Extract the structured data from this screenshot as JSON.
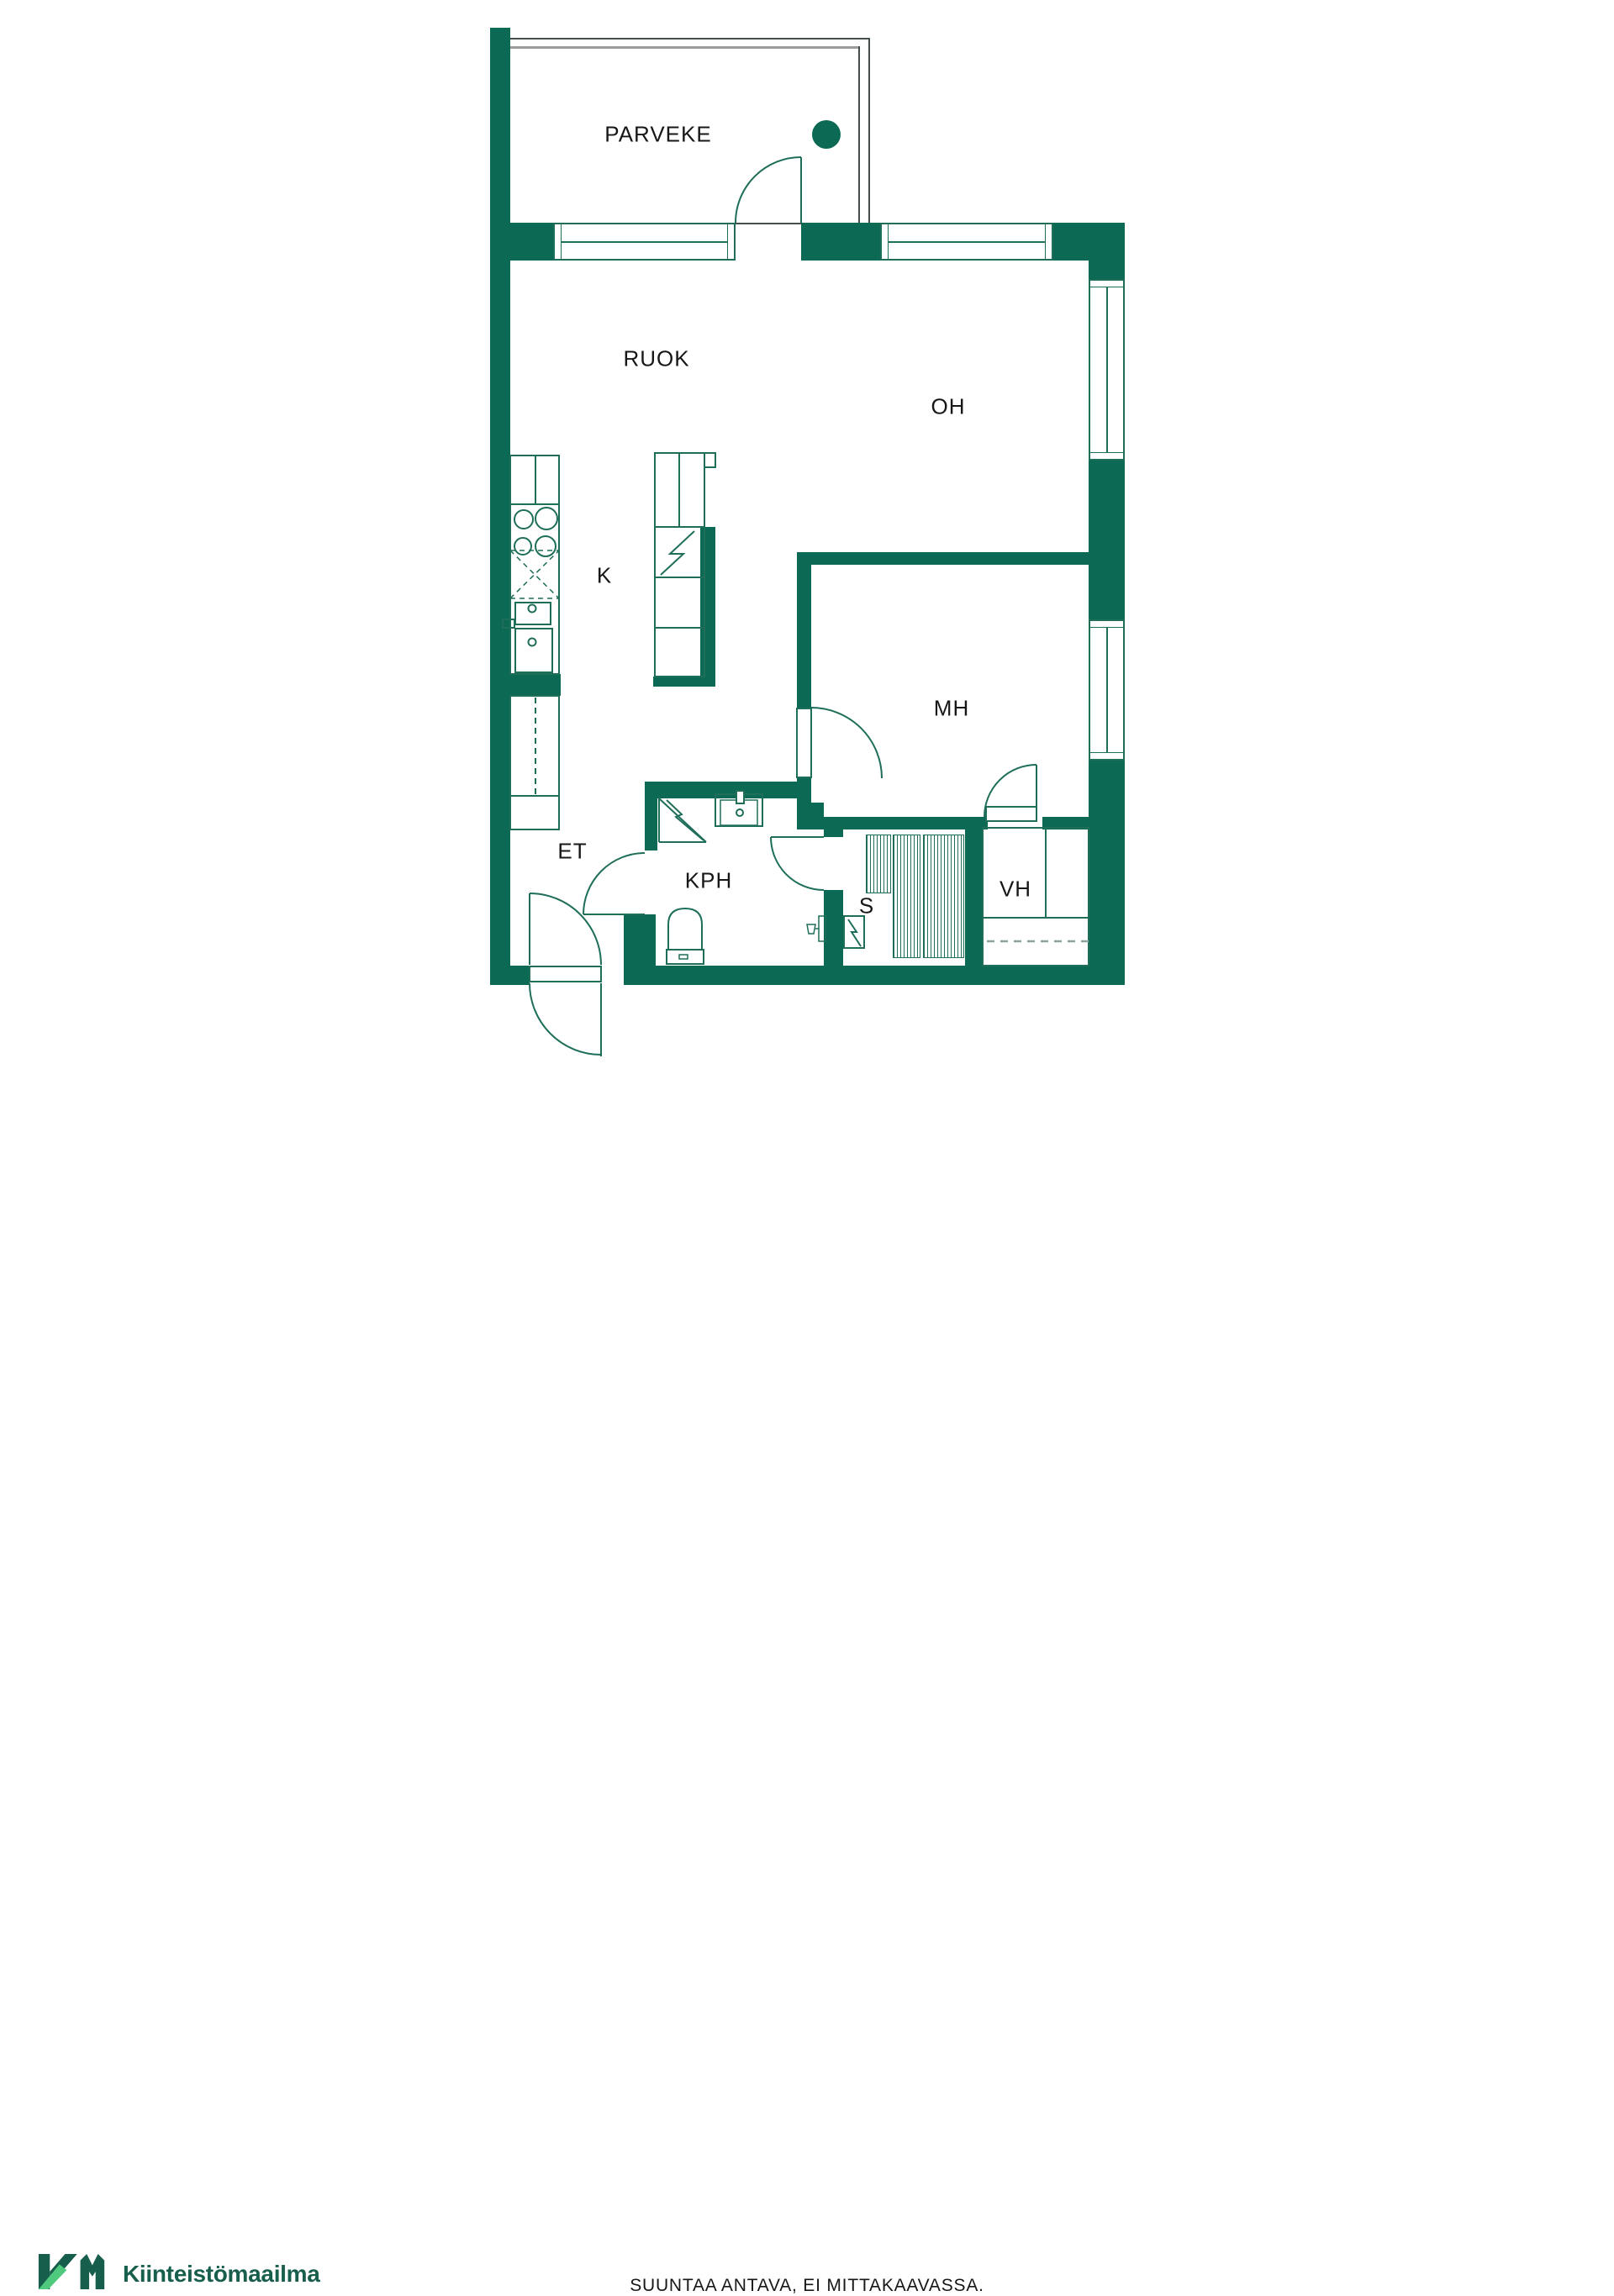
{
  "colors": {
    "wall": "#0c6a54",
    "line": "#1e6e59",
    "outline": "#454e4f",
    "gray": "#9b9b9b",
    "dash": "#8ba49c",
    "text": "#171717",
    "logo-dark": "#175e4c",
    "logo-light": "#4fc97e"
  },
  "floorplan": {
    "rooms": [
      {
        "id": "parveke",
        "label": "PARVEKE"
      },
      {
        "id": "ruok",
        "label": "RUOK"
      },
      {
        "id": "oh",
        "label": "OH"
      },
      {
        "id": "k",
        "label": "K"
      },
      {
        "id": "mh",
        "label": "MH"
      },
      {
        "id": "et",
        "label": "ET"
      },
      {
        "id": "kph",
        "label": "KPH"
      },
      {
        "id": "s",
        "label": "S"
      },
      {
        "id": "vh",
        "label": "VH"
      }
    ]
  },
  "footer": {
    "logo": {
      "monogram": "KM",
      "name": "Kiinteistömaailma"
    },
    "disclaimer": "SUUNTAA ANTAVA, EI MITTAKAAVASSA."
  }
}
